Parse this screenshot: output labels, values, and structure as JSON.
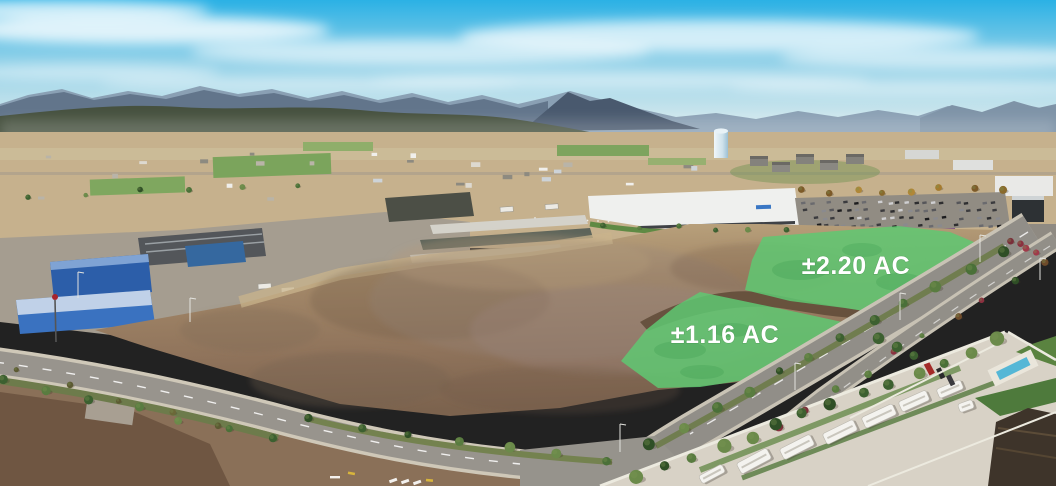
{
  "scene": {
    "parcels": [
      {
        "id": "parcel-2-20",
        "label": "±2.20 AC"
      },
      {
        "id": "parcel-1-16",
        "label": "±1.16 AC"
      }
    ],
    "colors": {
      "parcel_highlight": "#5fc872",
      "parcel_highlight_dark": "#3f9e52",
      "parcel_label": "#ffffff",
      "sky_top": "#2bb1e5",
      "sky_mid": "#8fd0e8",
      "sky_horizon": "#e0ecec",
      "mountain_far": "#8aa0b4",
      "mountain_near": "#4d5d73",
      "forest": "#46513f",
      "valley": "#c6b18d",
      "dirt_field": "#957a62",
      "dirt_dark": "#5f4a37",
      "asphalt": "#98948d",
      "warehouse_blue": "#2f63ac",
      "rv_concrete": "#d8d2c6",
      "lawn": "#567f3e",
      "pool": "#55b7d6"
    }
  }
}
